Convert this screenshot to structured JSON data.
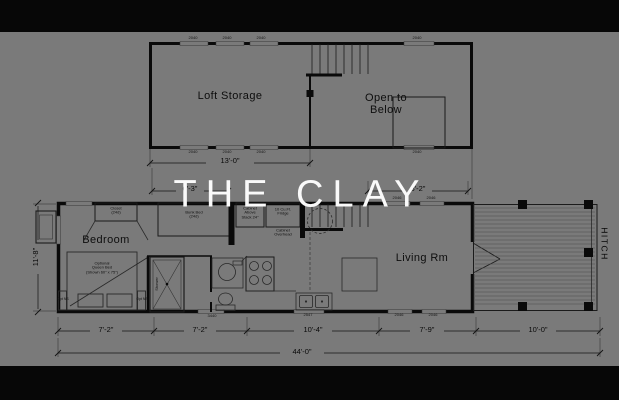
{
  "hero": {
    "title": "THE CLAY"
  },
  "loft": {
    "storage": "Loft Storage",
    "open_l1": "Open to",
    "open_l2": "Below",
    "dim": "13'-0\""
  },
  "rooms": {
    "bedroom": "Bedroom",
    "living": "Living Rm"
  },
  "fixtures": {
    "closet_l1": "Closet",
    "closet_l2": "(24d)",
    "bunk_l1": "Bunk Bed",
    "bunk_l2": "(24d)",
    "cab1_l1": "Cabinet",
    "cab1_l2": "Above",
    "cab1_l3": "Stack 24\"",
    "fridge_l1": "10 Cu.Ft.",
    "fridge_l2": "Fridge",
    "cab2_l1": "Cabinet",
    "cab2_l2": "Overhead",
    "bed_l1": "Optional",
    "bed_l2": "Queen Bed",
    "bed_l3": "(Shown 60\" x 75\")",
    "ns": "Opt NS",
    "shower": "Shower",
    "hitch": "HITCH"
  },
  "dims": {
    "top_left": "6'-3\"",
    "top_right": "8'-2\"",
    "height": "11'-8\"",
    "bottom": [
      "7'-2\"",
      "7'-2\"",
      "10'-4\"",
      "7'-9\"",
      "10'-0\""
    ],
    "total": "44'-0\""
  },
  "wtags": {
    "loft_top": [
      "2040",
      "2040",
      "2040",
      "2040"
    ],
    "loft_bottom": [
      "2040",
      "2040",
      "2040",
      "2040"
    ],
    "main_top": [
      "2046",
      "2046"
    ],
    "main_bottom": [
      "3440",
      "2547",
      "2046",
      "2046"
    ]
  },
  "colors": {
    "overlay": "rgba(0,0,0,0.52)",
    "bar": "#070707",
    "wall": "#151515",
    "title_text": "#fafafa"
  }
}
